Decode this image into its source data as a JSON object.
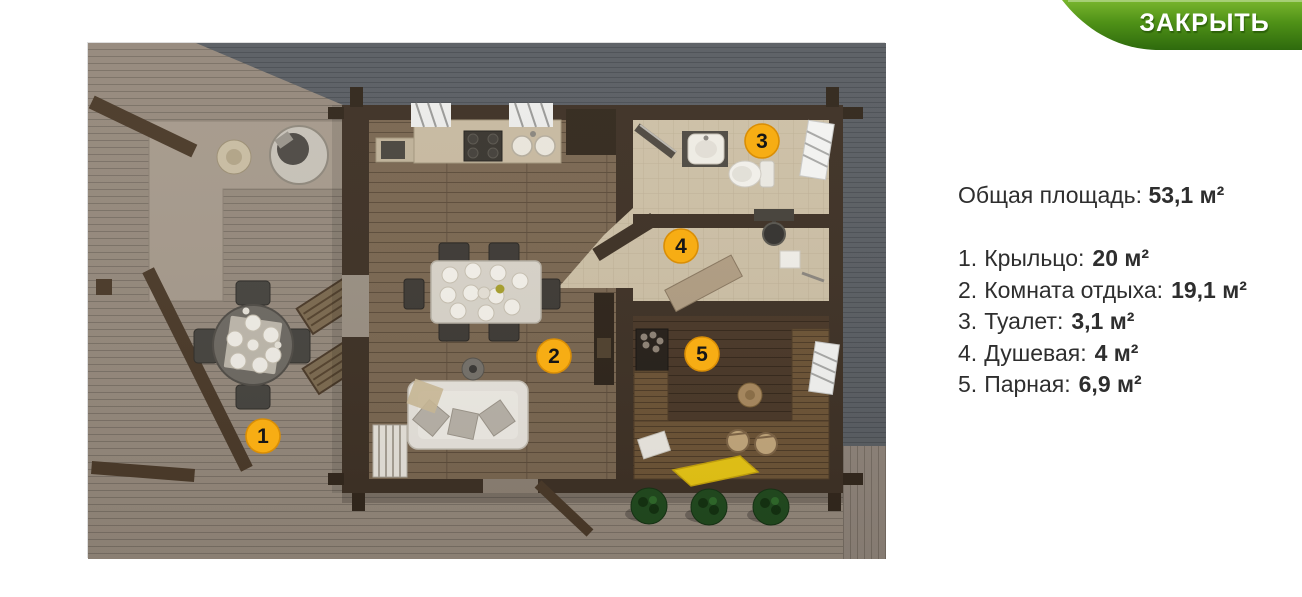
{
  "close_button": {
    "label": "ЗАКРЫТЬ"
  },
  "legend": {
    "total": {
      "label": "Общая площадь:",
      "value": "53,1 м²"
    },
    "rooms": [
      {
        "prefix": "1.",
        "name": "Крыльцо:",
        "area": "20 м²"
      },
      {
        "prefix": "2.",
        "name": "Комната отдыха:",
        "area": "19,1 м²"
      },
      {
        "prefix": "3.",
        "name": "Туалет:",
        "area": "3,1 м²"
      },
      {
        "prefix": "4.",
        "name": "Душевая:",
        "area": "4 м²"
      },
      {
        "prefix": "5.",
        "name": "Парная:",
        "area": "6,9 м²"
      }
    ]
  },
  "floorplan": {
    "markers": [
      {
        "num": "1"
      },
      {
        "num": "2"
      },
      {
        "num": "3"
      },
      {
        "num": "4"
      },
      {
        "num": "5"
      }
    ]
  },
  "colors": {
    "marker-fill": "#f7ad14",
    "marker-stroke": "#d98e06",
    "marker-number": "#161616",
    "text": "#2e2e2e",
    "accent-green-top": "#79b62e",
    "accent-green-mid": "#4f9117",
    "accent-green-bottom": "#2e6a0d"
  }
}
